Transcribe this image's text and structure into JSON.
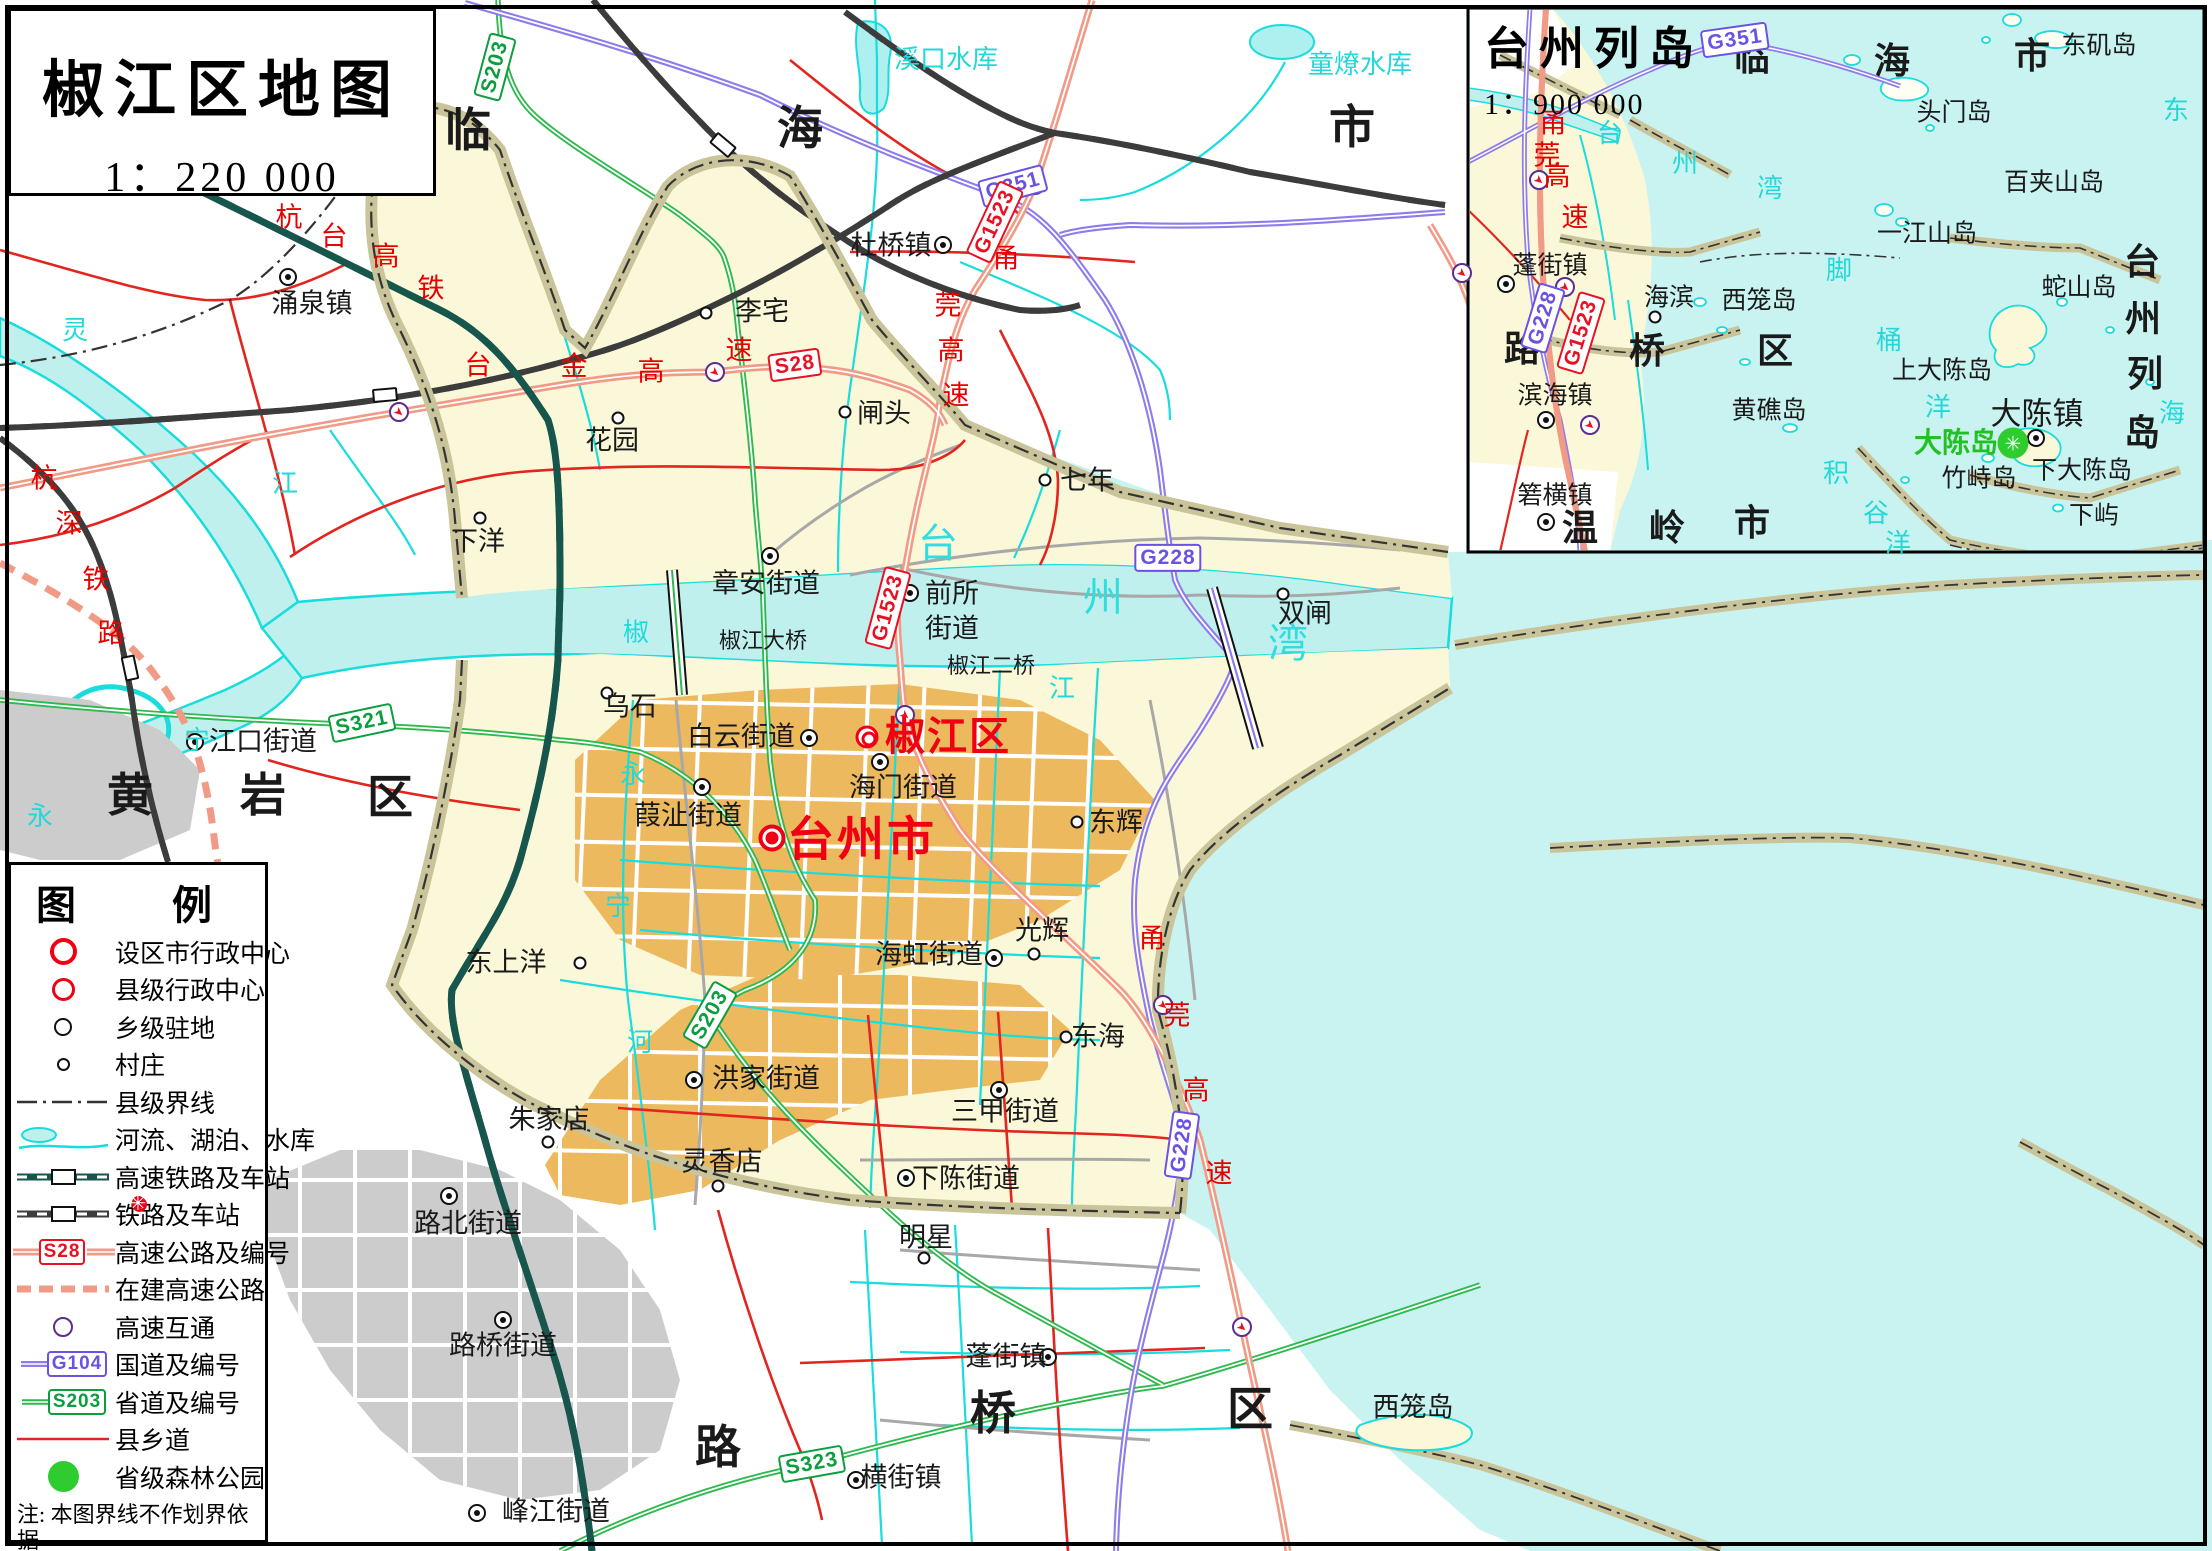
{
  "title_box": {
    "title": "椒江区地图",
    "scale": "1：220 000"
  },
  "inset_head": {
    "title": "台州列岛",
    "scale": "1：900 000"
  },
  "legend": {
    "header": "图　例",
    "items": [
      {
        "symbol": "city",
        "label": "设区市行政中心"
      },
      {
        "symbol": "county",
        "label": "县级行政中心"
      },
      {
        "symbol": "town",
        "label": "乡级驻地"
      },
      {
        "symbol": "village",
        "label": "村庄"
      },
      {
        "symbol": "boundary",
        "label": "县级界线"
      },
      {
        "symbol": "water",
        "label": "河流、湖泊、水库"
      },
      {
        "symbol": "hsr",
        "label": "高速铁路及车站"
      },
      {
        "symbol": "rail",
        "label": "铁路及车站"
      },
      {
        "symbol": "expressway",
        "badge": "S28",
        "badge_kind": "x",
        "label": "高速公路及编号"
      },
      {
        "symbol": "expressway-uc",
        "label": "在建高速公路"
      },
      {
        "symbol": "interchange",
        "label": "高速互通"
      },
      {
        "symbol": "national",
        "badge": "G104",
        "badge_kind": "g",
        "label": "国道及编号"
      },
      {
        "symbol": "provincial",
        "badge": "S203",
        "badge_kind": "s",
        "label": "省道及编号"
      },
      {
        "symbol": "county-road",
        "label": "县乡道"
      },
      {
        "symbol": "forest",
        "label": "省级森林公园"
      }
    ],
    "notes": [
      "注: 本图界线不作划界依据",
      "地图审核号: 浙S(2024)38号"
    ]
  },
  "colors": {
    "sea": "#c9f3f1",
    "river": "#bff0ee",
    "land": "#faf8d8",
    "urban": "#edb95e",
    "urban_gray": "#cccccc",
    "dyke": "#c9c49a",
    "expressway": "#f19a86",
    "national": "#8f7bea",
    "provincial": "#2db94d",
    "county_road": "#e3251f",
    "hsr": "#17564c",
    "red_label": "#e60000",
    "water_label": "#25d8d8"
  },
  "map_labels": [
    [
      "涌泉镇",
      312,
      304,
      "place"
    ],
    [
      "李宅",
      762,
      312,
      "place"
    ],
    [
      "花园",
      612,
      441,
      "place"
    ],
    [
      "闸头",
      884,
      414,
      "place"
    ],
    [
      "下洋",
      478,
      542,
      "place"
    ],
    [
      "七年",
      1087,
      481,
      "place"
    ],
    [
      "杜桥镇",
      891,
      246,
      "place"
    ],
    [
      "章安街道",
      766,
      584,
      "place"
    ],
    [
      "前所",
      952,
      594,
      "place"
    ],
    [
      "街道",
      952,
      629,
      "place"
    ],
    [
      "双闸",
      1305,
      614,
      "place"
    ],
    [
      "乌石",
      630,
      707,
      "place"
    ],
    [
      "白云街道",
      741,
      737,
      "place"
    ],
    [
      "海门街道",
      903,
      788,
      "place"
    ],
    [
      "葭沚街道",
      688,
      816,
      "place"
    ],
    [
      "东辉",
      1116,
      823,
      "place"
    ],
    [
      "光辉",
      1042,
      931,
      "place"
    ],
    [
      "海虹街道",
      929,
      955,
      "place"
    ],
    [
      "东上洋",
      506,
      963,
      "place"
    ],
    [
      "洪家街道",
      766,
      1079,
      "place"
    ],
    [
      "朱家店",
      549,
      1120,
      "place"
    ],
    [
      "灵香店",
      722,
      1162,
      "place"
    ],
    [
      "路北街道",
      468,
      1224,
      "place"
    ],
    [
      "路桥街道",
      503,
      1346,
      "place"
    ],
    [
      "明星",
      926,
      1238,
      "place"
    ],
    [
      "下陈街道",
      966,
      1179,
      "place"
    ],
    [
      "三甲街道",
      1005,
      1112,
      "place"
    ],
    [
      "东海",
      1098,
      1037,
      "place"
    ],
    [
      "蓬街镇",
      1006,
      1357,
      "place"
    ],
    [
      "横街镇",
      901,
      1478,
      "place"
    ],
    [
      "峰江街道",
      556,
      1512,
      "place"
    ],
    [
      "江口街道",
      263,
      742,
      "place"
    ],
    [
      "西笼岛",
      1413,
      1408,
      "place"
    ],
    [
      "椒江大桥",
      763,
      641,
      "place-sm"
    ],
    [
      "椒江二桥",
      991,
      666,
      "place-sm"
    ],
    [
      "临",
      468,
      130,
      "dist"
    ],
    [
      "海",
      800,
      128,
      "dist"
    ],
    [
      "市",
      1352,
      127,
      "dist"
    ],
    [
      "黄",
      130,
      795,
      "dist"
    ],
    [
      "岩",
      263,
      795,
      "dist"
    ],
    [
      "区",
      390,
      797,
      "dist"
    ],
    [
      "路",
      718,
      1447,
      "dist"
    ],
    [
      "桥",
      993,
      1413,
      "dist"
    ],
    [
      "区",
      1250,
      1409,
      "dist"
    ],
    [
      "台州市",
      862,
      841,
      "red-city"
    ],
    [
      "椒江区",
      948,
      737,
      "red-county"
    ],
    [
      "杭",
      289,
      218,
      "roadchar"
    ],
    [
      "台",
      334,
      237,
      "roadchar"
    ],
    [
      "高",
      386,
      257,
      "roadchar"
    ],
    [
      "铁",
      431,
      289,
      "roadchar"
    ],
    [
      "杭",
      44,
      479,
      "roadchar"
    ],
    [
      "深",
      69,
      524,
      "roadchar"
    ],
    [
      "铁",
      96,
      580,
      "roadchar"
    ],
    [
      "路",
      111,
      634,
      "roadchar"
    ],
    [
      "台",
      478,
      366,
      "roadchar"
    ],
    [
      "金",
      574,
      367,
      "roadchar"
    ],
    [
      "高",
      651,
      372,
      "roadchar"
    ],
    [
      "速",
      739,
      351,
      "roadchar"
    ],
    [
      "甬",
      1006,
      259,
      "roadchar"
    ],
    [
      "莞",
      948,
      306,
      "roadchar"
    ],
    [
      "高",
      951,
      351,
      "roadchar"
    ],
    [
      "速",
      956,
      396,
      "roadchar"
    ],
    [
      "甬",
      1152,
      939,
      "roadchar"
    ],
    [
      "莞",
      1177,
      1016,
      "roadchar"
    ],
    [
      "高",
      1196,
      1091,
      "roadchar"
    ],
    [
      "速",
      1219,
      1174,
      "roadchar"
    ],
    [
      "甬",
      1553,
      124,
      "roadchar"
    ],
    [
      "莞",
      1547,
      156,
      "roadchar"
    ],
    [
      "高",
      1557,
      177,
      "roadchar"
    ],
    [
      "速",
      1575,
      218,
      "roadchar"
    ],
    [
      "溪口水库",
      946,
      60,
      "water"
    ],
    [
      "童燎水库",
      1360,
      65,
      "water"
    ],
    [
      "灵",
      75,
      331,
      "water"
    ],
    [
      "江",
      285,
      484,
      "water"
    ],
    [
      "椒",
      636,
      633,
      "water"
    ],
    [
      "江",
      1062,
      689,
      "water"
    ],
    [
      "宁",
      197,
      741,
      "water"
    ],
    [
      "永",
      40,
      817,
      "water"
    ],
    [
      "永",
      633,
      775,
      "water"
    ],
    [
      "宁",
      618,
      907,
      "water"
    ],
    [
      "河",
      640,
      1043,
      "water"
    ],
    [
      "台",
      939,
      544,
      "water-lg"
    ],
    [
      "州",
      1104,
      598,
      "water-lg"
    ],
    [
      "湾",
      1289,
      644,
      "water-lg"
    ],
    [
      "台",
      1610,
      134,
      "water"
    ],
    [
      "州",
      1685,
      164,
      "water"
    ],
    [
      "湾",
      1770,
      189,
      "water"
    ],
    [
      "东",
      2176,
      111,
      "water"
    ],
    [
      "海",
      2172,
      414,
      "water"
    ],
    [
      "脚",
      1839,
      271,
      "water"
    ],
    [
      "桶",
      1889,
      341,
      "water"
    ],
    [
      "洋",
      1938,
      408,
      "water"
    ],
    [
      "积",
      1836,
      474,
      "water"
    ],
    [
      "谷",
      1876,
      514,
      "water"
    ],
    [
      "洋",
      1898,
      544,
      "water"
    ],
    [
      "蓬街镇",
      1550,
      266,
      "place-i"
    ],
    [
      "海滨",
      1669,
      298,
      "place-i"
    ],
    [
      "西笼岛",
      1759,
      301,
      "place-i"
    ],
    [
      "滨海镇",
      1555,
      396,
      "place-i"
    ],
    [
      "黄礁岛",
      1769,
      411,
      "place-i"
    ],
    [
      "箬横镇",
      1555,
      496,
      "place-i"
    ],
    [
      "大陈镇",
      2037,
      414,
      "place-lg"
    ],
    [
      "头门岛",
      1954,
      113,
      "place-i"
    ],
    [
      "东矶岛",
      2099,
      46,
      "place-i"
    ],
    [
      "百夹山岛",
      2054,
      183,
      "place-i"
    ],
    [
      "一江山岛",
      1927,
      234,
      "place-i"
    ],
    [
      "蛇山岛",
      2079,
      288,
      "place-i"
    ],
    [
      "上大陈岛",
      1942,
      371,
      "place-i"
    ],
    [
      "下大陈岛",
      2082,
      471,
      "place-i"
    ],
    [
      "竹峙岛",
      1979,
      479,
      "place-i"
    ],
    [
      "下屿",
      2094,
      516,
      "place-i"
    ],
    [
      "临",
      1752,
      58,
      "dist-i"
    ],
    [
      "海",
      1892,
      61,
      "dist-i"
    ],
    [
      "市",
      2032,
      56,
      "dist-i"
    ],
    [
      "路",
      1522,
      349,
      "dist-i"
    ],
    [
      "桥",
      1647,
      351,
      "dist-i"
    ],
    [
      "区",
      1775,
      351,
      "dist-i"
    ],
    [
      "温",
      1580,
      528,
      "dist-i"
    ],
    [
      "岭",
      1667,
      528,
      "dist-i"
    ],
    [
      "市",
      1752,
      523,
      "dist-i"
    ],
    [
      "台",
      2142,
      262,
      "dist-i"
    ],
    [
      "州",
      2143,
      319,
      "dist-i"
    ],
    [
      "列",
      2145,
      374,
      "dist-i"
    ],
    [
      "岛",
      2142,
      433,
      "dist-i"
    ],
    [
      "大陈岛",
      1956,
      444,
      "green-label"
    ]
  ],
  "badges": [
    [
      "S203",
      495,
      67,
      -75,
      "s"
    ],
    [
      "G351",
      1013,
      186,
      -15,
      "g"
    ],
    [
      "S28",
      795,
      365,
      -8,
      "x"
    ],
    [
      "S321",
      362,
      723,
      -12,
      "s"
    ],
    [
      "G228",
      1168,
      558,
      0,
      "g"
    ],
    [
      "G1523",
      995,
      222,
      -65,
      "x"
    ],
    [
      "G1523",
      888,
      608,
      -75,
      "x"
    ],
    [
      "S203",
      710,
      1015,
      -60,
      "s"
    ],
    [
      "G228",
      1182,
      1145,
      -82,
      "g"
    ],
    [
      "S323",
      812,
      1464,
      -10,
      "s"
    ],
    [
      "G351",
      1735,
      40,
      -8,
      "g"
    ],
    [
      "G228",
      1543,
      318,
      -73,
      "g"
    ],
    [
      "G1523",
      1581,
      333,
      -73,
      "x"
    ]
  ],
  "markers": [
    [
      "city",
      772,
      838
    ],
    [
      "county",
      867,
      737
    ],
    [
      "town",
      288,
      277
    ],
    [
      "town",
      943,
      245
    ],
    [
      "town",
      770,
      556
    ],
    [
      "town",
      910,
      593
    ],
    [
      "town",
      195,
      742
    ],
    [
      "town",
      809,
      738
    ],
    [
      "town",
      880,
      762
    ],
    [
      "town",
      702,
      787
    ],
    [
      "town",
      994,
      958
    ],
    [
      "town",
      694,
      1080
    ],
    [
      "town",
      449,
      1196
    ],
    [
      "town",
      503,
      1320
    ],
    [
      "town",
      906,
      1178
    ],
    [
      "town",
      999,
      1090
    ],
    [
      "town",
      1048,
      1357
    ],
    [
      "town",
      856,
      1480
    ],
    [
      "town",
      477,
      1513
    ],
    [
      "town",
      1506,
      284
    ],
    [
      "town",
      1546,
      420
    ],
    [
      "town",
      1546,
      522
    ],
    [
      "town",
      2036,
      438
    ],
    [
      "village",
      706,
      313
    ],
    [
      "village",
      618,
      418
    ],
    [
      "village",
      845,
      412
    ],
    [
      "village",
      480,
      518
    ],
    [
      "village",
      1045,
      480
    ],
    [
      "village",
      1283,
      594
    ],
    [
      "village",
      607,
      693
    ],
    [
      "village",
      1077,
      822
    ],
    [
      "village",
      1034,
      954
    ],
    [
      "village",
      580,
      963
    ],
    [
      "village",
      548,
      1142
    ],
    [
      "village",
      718,
      1186
    ],
    [
      "village",
      924,
      1258
    ],
    [
      "village",
      1066,
      1037
    ],
    [
      "village",
      1655,
      317
    ],
    [
      "inter",
      399,
      412
    ],
    [
      "inter",
      715,
      372
    ],
    [
      "inter",
      1035,
      185
    ],
    [
      "inter",
      905,
      715
    ],
    [
      "inter",
      1163,
      1005
    ],
    [
      "inter",
      1242,
      1327
    ],
    [
      "inter",
      1462,
      273
    ],
    [
      "inter",
      1539,
      180
    ],
    [
      "inter",
      1565,
      287
    ],
    [
      "inter",
      1590,
      425
    ],
    [
      "station",
      723,
      145,
      40
    ],
    [
      "station",
      385,
      395,
      -5
    ],
    [
      "station",
      130,
      668,
      78
    ],
    [
      "forest",
      2013,
      443
    ]
  ]
}
